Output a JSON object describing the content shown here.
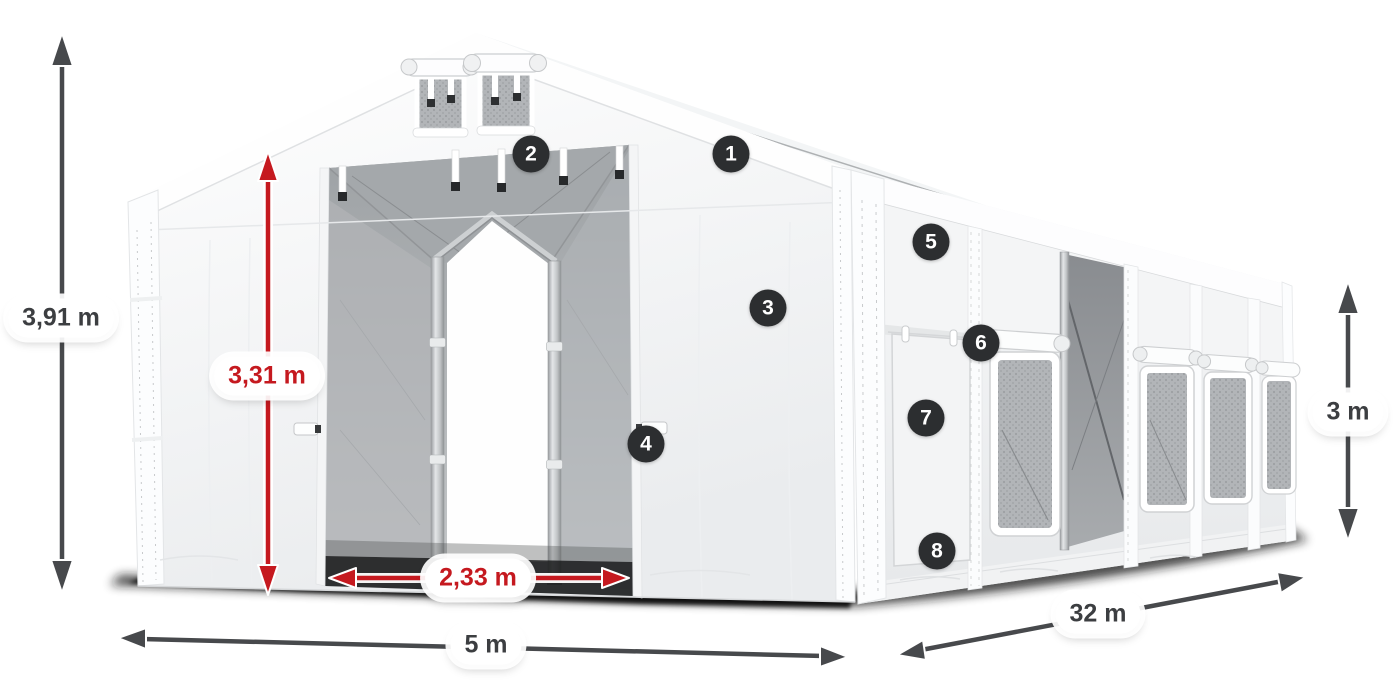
{
  "dimensions": {
    "total_height": {
      "label": "3,91 m"
    },
    "door_height": {
      "label": "3,31 m"
    },
    "door_width": {
      "label": "2,33 m"
    },
    "width": {
      "label": "5 m"
    },
    "length": {
      "label": "32 m"
    },
    "side_height": {
      "label": "3 m"
    }
  },
  "markers": [
    {
      "number": "1"
    },
    {
      "number": "2"
    },
    {
      "number": "3"
    },
    {
      "number": "4"
    },
    {
      "number": "5"
    },
    {
      "number": "6"
    },
    {
      "number": "7"
    },
    {
      "number": "8"
    }
  ],
  "colors": {
    "dimension_red": "#c5191f",
    "dimension_gray": "#47494c",
    "marker_background": "#2c2e30",
    "marker_text": "#ffffff",
    "pill_background": "#ffffff",
    "tent_white": "#f7f8fa",
    "interior_gray": "#aeb1b4"
  }
}
